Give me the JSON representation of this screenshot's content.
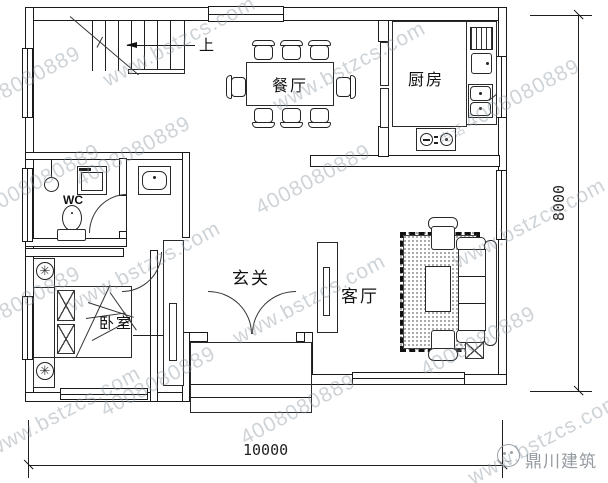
{
  "rooms": {
    "dining": "餐厅",
    "kitchen": "厨房",
    "wc": "WC",
    "hall": "玄关",
    "living": "客厅",
    "bedroom": "卧室"
  },
  "stairs": {
    "up_label": "上"
  },
  "dimensions": {
    "width": "10000",
    "height": "8000"
  },
  "watermark": {
    "site": "www.bstzcs.com",
    "phone": "4008080889",
    "phone_prefix": "电话"
  },
  "logo": {
    "company": "鼎川建筑"
  },
  "icons": {
    "plant_glyph": "✳"
  }
}
